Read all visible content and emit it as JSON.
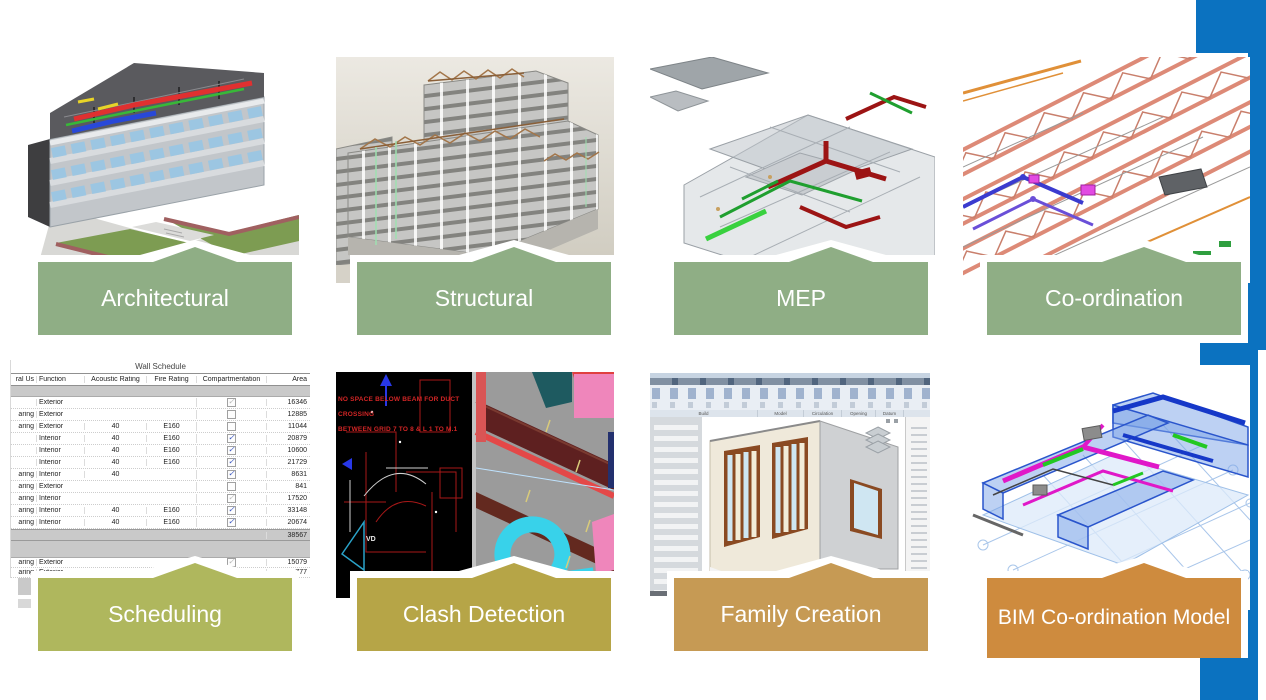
{
  "slide": {
    "background": "#ffffff",
    "accent_blue": "#0B72C0",
    "banner_text_color": "#ffffff"
  },
  "panels": [
    {
      "label": "Architectural",
      "banner_color": "#8FAE85"
    },
    {
      "label": "Structural",
      "banner_color": "#8FAE85"
    },
    {
      "label": "MEP",
      "banner_color": "#8FAE85"
    },
    {
      "label": "Co-ordination",
      "banner_color": "#8FAE85"
    },
    {
      "label": "Scheduling",
      "banner_color": "#AFB75D"
    },
    {
      "label": "Clash Detection",
      "banner_color": "#B6A547"
    },
    {
      "label": "Family Creation",
      "banner_color": "#C69A54"
    },
    {
      "label": "BIM Co-ordination Model",
      "banner_color": "#CE8B3E"
    }
  ],
  "wall_schedule": {
    "title": "Wall Schedule",
    "columns": [
      "ral Us",
      "Function",
      "Acoustic Rating",
      "Fire Rating",
      "Compartmentation",
      "Area"
    ],
    "rows": [
      {
        "usage": "",
        "function": "Exterior",
        "acoustic": "",
        "fire": "",
        "compartmentation": "gray-check",
        "area": "16346"
      },
      {
        "usage": "aring",
        "function": "Exterior",
        "acoustic": "",
        "fire": "",
        "compartmentation": "unchecked",
        "area": "12885"
      },
      {
        "usage": "aring",
        "function": "Exterior",
        "acoustic": "40",
        "fire": "E160",
        "compartmentation": "unchecked",
        "area": "11044"
      },
      {
        "usage": "",
        "function": "Interior",
        "acoustic": "40",
        "fire": "E160",
        "compartmentation": "checked",
        "area": "20879"
      },
      {
        "usage": "",
        "function": "Interior",
        "acoustic": "40",
        "fire": "E160",
        "compartmentation": "checked",
        "area": "10600"
      },
      {
        "usage": "",
        "function": "Interior",
        "acoustic": "40",
        "fire": "E160",
        "compartmentation": "checked",
        "area": "21729"
      },
      {
        "usage": "aring",
        "function": "Interior",
        "acoustic": "40",
        "fire": "",
        "compartmentation": "checked",
        "area": "8631"
      },
      {
        "usage": "aring",
        "function": "Exterior",
        "acoustic": "",
        "fire": "",
        "compartmentation": "unchecked",
        "area": "841"
      },
      {
        "usage": "aring",
        "function": "Interior",
        "acoustic": "",
        "fire": "",
        "compartmentation": "gray-check",
        "area": "17520"
      },
      {
        "usage": "aring",
        "function": "Interior",
        "acoustic": "40",
        "fire": "E160",
        "compartmentation": "checked",
        "area": "33148"
      },
      {
        "usage": "aring",
        "function": "Interior",
        "acoustic": "40",
        "fire": "E160",
        "compartmentation": "checked",
        "area": "20674"
      }
    ],
    "total_area": "38567",
    "extra_rows": [
      {
        "usage": "aring",
        "function": "Exterior",
        "acoustic": "",
        "fire": "",
        "compartmentation": "gray-check",
        "area": "15079"
      },
      {
        "usage": "aring",
        "function": "Exterior",
        "acoustic": "",
        "fire": "",
        "compartmentation": "none",
        "area": "777"
      }
    ]
  },
  "clash_note": {
    "line1": "NO SPACE BELOW BEAM FOR DUCT CROSSING",
    "line2": "BETWEEN GRID 7 TO 8 & L 1 TO M.1",
    "cad_label": "VD"
  },
  "revit_ui": {
    "ribbon_groups": [
      "Build",
      "Model",
      "Circulation",
      "Opening",
      "Datum"
    ]
  }
}
